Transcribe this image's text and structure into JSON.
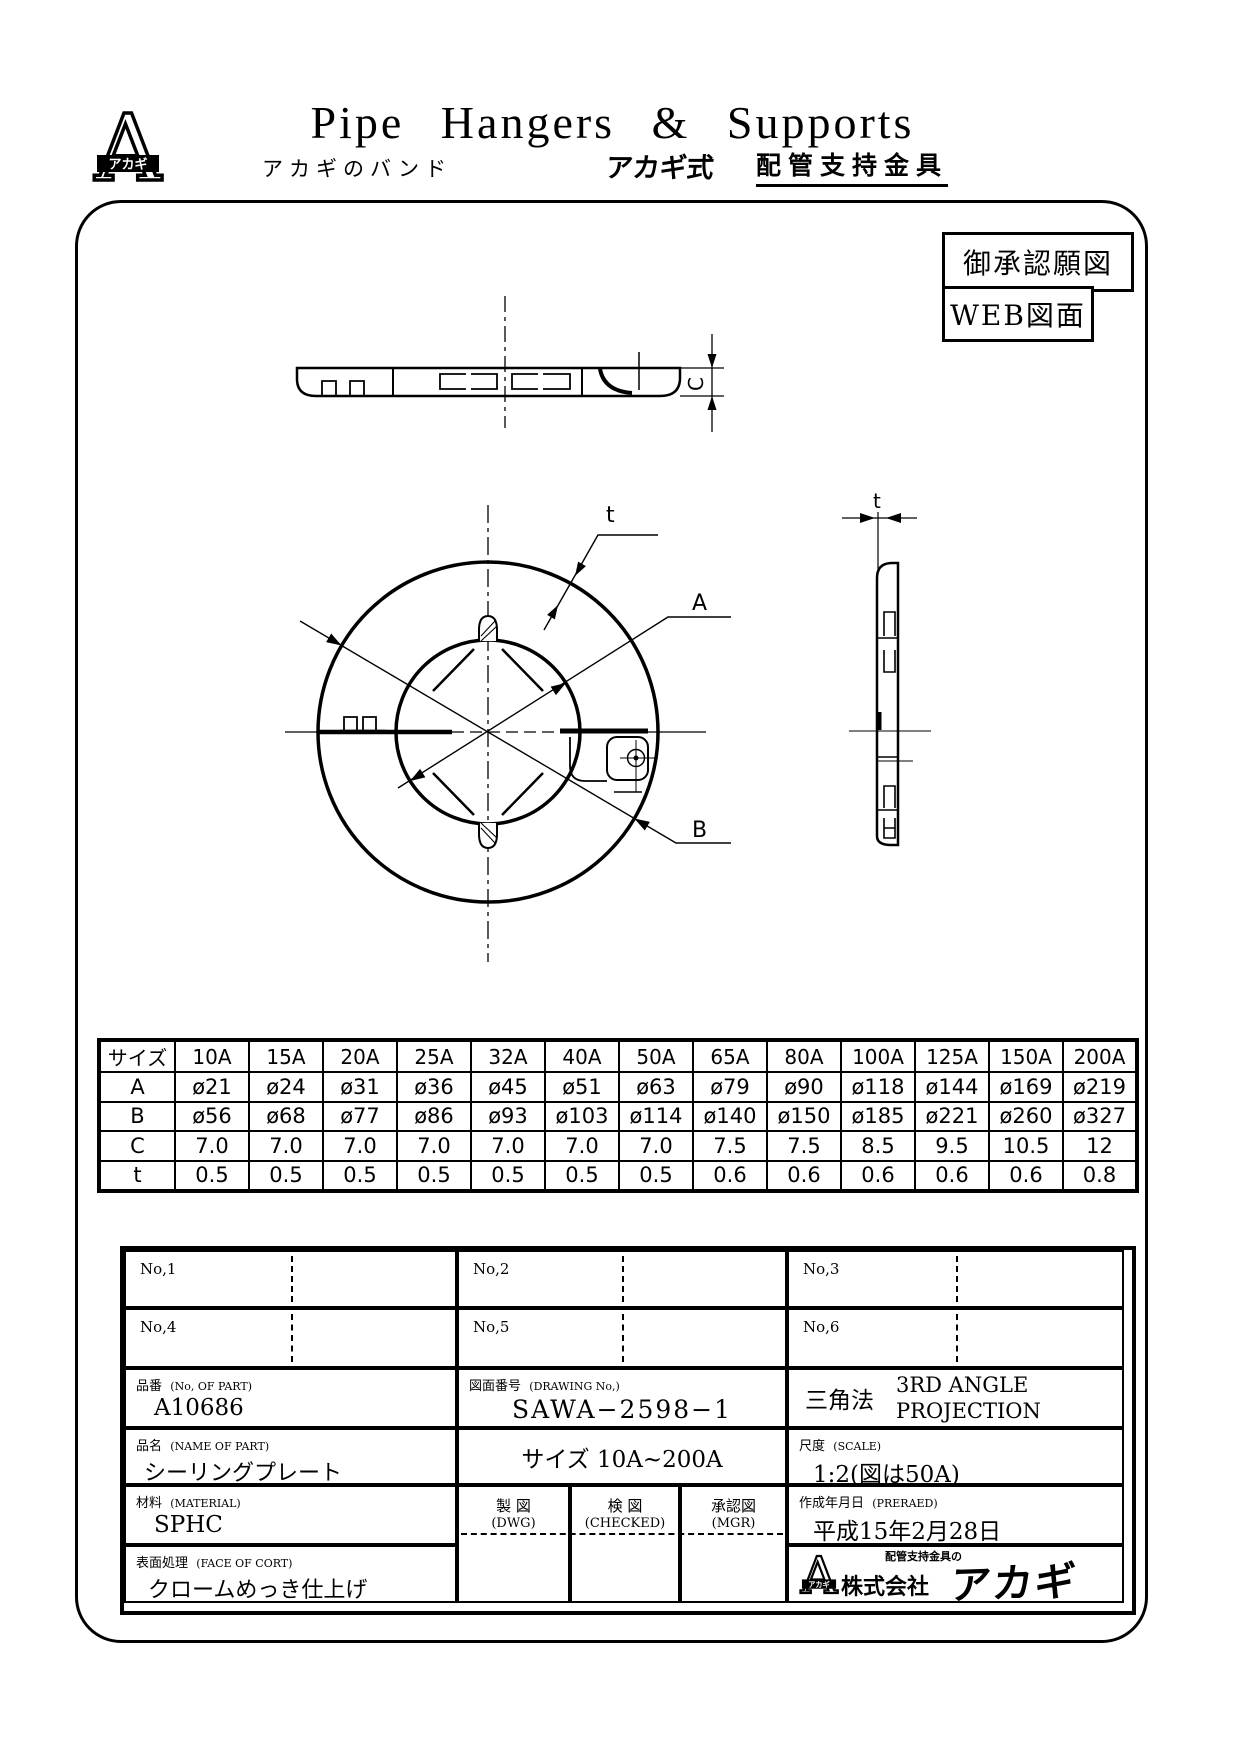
{
  "page": {
    "background": "#ffffff",
    "ink": "#000000"
  },
  "header": {
    "title": "Pipe  Hangers  &  Supports",
    "subtitle_left": "アカギのバンド",
    "brand": "アカギ式",
    "subtitle_right": "配管支持金具",
    "logo_letter": "A",
    "logo_band": "アカギ"
  },
  "stamps": {
    "approval": "御承認願図",
    "web": "WEB図面"
  },
  "drawing": {
    "label_t": "t",
    "label_a": "A",
    "label_b": "B",
    "label_c": "C",
    "label_t_side": "t"
  },
  "size_table": {
    "header_label": "サイズ",
    "sizes": [
      "10A",
      "15A",
      "20A",
      "25A",
      "32A",
      "40A",
      "50A",
      "65A",
      "80A",
      "100A",
      "125A",
      "150A",
      "200A"
    ],
    "rows": [
      {
        "label": "A",
        "values": [
          "ø21",
          "ø24",
          "ø31",
          "ø36",
          "ø45",
          "ø51",
          "ø63",
          "ø79",
          "ø90",
          "ø118",
          "ø144",
          "ø169",
          "ø219"
        ]
      },
      {
        "label": "B",
        "values": [
          "ø56",
          "ø68",
          "ø77",
          "ø86",
          "ø93",
          "ø103",
          "ø114",
          "ø140",
          "ø150",
          "ø185",
          "ø221",
          "ø260",
          "ø327"
        ]
      },
      {
        "label": "C",
        "values": [
          "7.0",
          "7.0",
          "7.0",
          "7.0",
          "7.0",
          "7.0",
          "7.0",
          "7.5",
          "7.5",
          "8.5",
          "9.5",
          "10.5",
          "12"
        ]
      },
      {
        "label": "t",
        "values": [
          "0.5",
          "0.5",
          "0.5",
          "0.5",
          "0.5",
          "0.5",
          "0.5",
          "0.6",
          "0.6",
          "0.6",
          "0.6",
          "0.6",
          "0.8"
        ]
      }
    ]
  },
  "title_block": {
    "no_labels": [
      "No,1",
      "No,2",
      "No,3",
      "No,4",
      "No,5",
      "No,6"
    ],
    "part_no": {
      "label": "品番",
      "label_en": "(No, OF PART)",
      "value": "A10686"
    },
    "drawing_no": {
      "label": "図面番号",
      "label_en": "(DRAWING No,)",
      "value": "SAWA−2598−1"
    },
    "projection": {
      "method": "三角法",
      "en_line1": "3RD  ANGLE",
      "en_line2": "PROJECTION"
    },
    "part_name": {
      "label": "品名",
      "label_en": "(NAME OF PART)",
      "value": "シーリングプレート"
    },
    "size_range": "サイズ 10A~200A",
    "scale": {
      "label": "尺度",
      "label_en": "(SCALE)",
      "value": "1:2(図は50A)"
    },
    "material": {
      "label": "材料",
      "label_en": "(MATERIAL)",
      "value": "SPHC"
    },
    "sign_columns": [
      {
        "label": "製 図",
        "label_en": "(DWG)"
      },
      {
        "label": "検 図",
        "label_en": "(CHECKED)"
      },
      {
        "label": "承認図",
        "label_en": "(MGR)"
      }
    ],
    "date": {
      "label": "作成年月日",
      "label_en": "(PRERAED)",
      "value": "平成15年2月28日"
    },
    "surface": {
      "label": "表面処理",
      "label_en": "(FACE OF CORT)",
      "value": "クロームめっき仕上げ"
    },
    "company": {
      "tagline": "配管支持金具の",
      "corp": "株式会社",
      "brand": "アカギ",
      "logo_letter": "A",
      "logo_band": "アカギ"
    }
  }
}
